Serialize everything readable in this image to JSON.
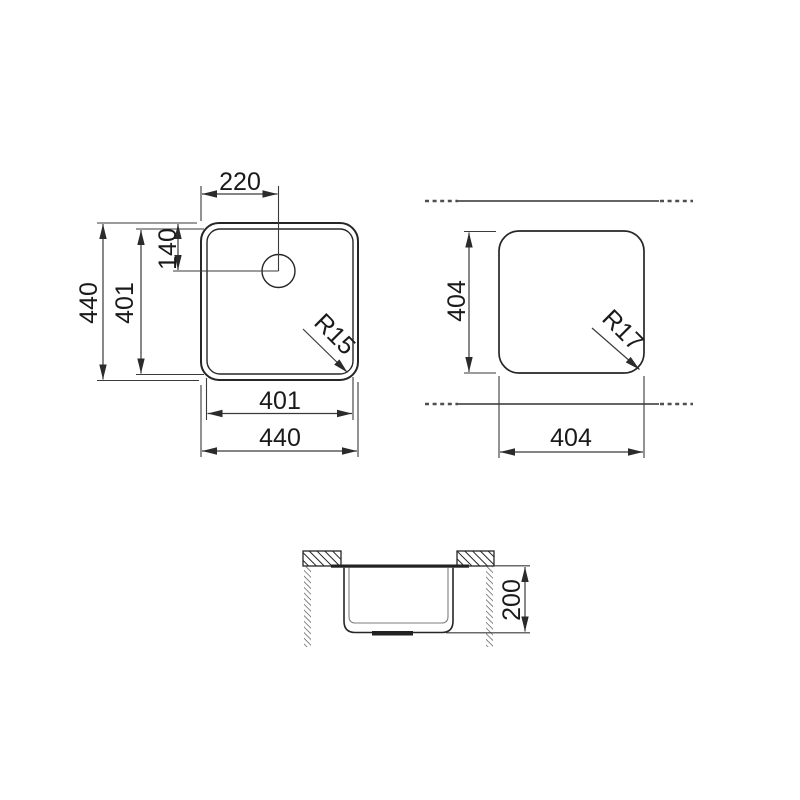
{
  "title": "Sink technical drawing",
  "colors": {
    "background": "#ffffff",
    "line_dark": "#262626",
    "line_dim": "#3a3a3a",
    "line_light": "#7d7d7d",
    "chain": "#4f4f4f"
  },
  "top_view": {
    "dim_tap_offset_x": "220",
    "dim_tap_offset_y": "140",
    "dim_height_overall": "440",
    "dim_height_inner": "401",
    "dim_width_inner": "401",
    "dim_width_overall": "440",
    "corner_radius": "R15"
  },
  "cutout_view": {
    "dim_height": "404",
    "dim_width": "404",
    "corner_radius": "R17"
  },
  "section_view": {
    "dim_depth": "200"
  }
}
